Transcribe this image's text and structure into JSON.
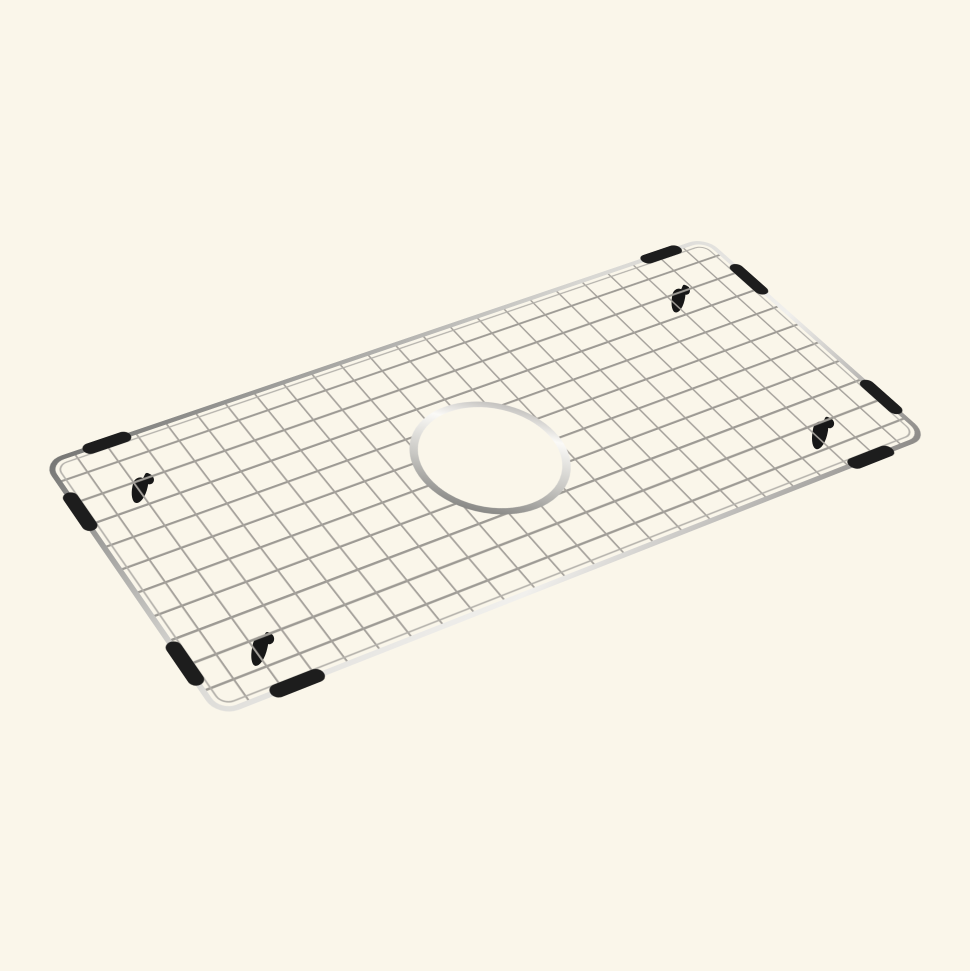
{
  "canvas": {
    "width": 970,
    "height": 971,
    "background": "#FAF6EA"
  },
  "subject": "stainless-steel-sink-bottom-grid",
  "grid": {
    "transform": "matrix3d(1.075, -0.27845, 0, 0.00018135, 0.50751, 0.59261, 0, -0.00036312, 0, 0, 1, 0, 42, 462, 0, 1)",
    "surface": {
      "width": 700,
      "height": 300,
      "corner_radius": 16,
      "edge_inset": 9,
      "inner_corner_radius": 10
    },
    "wires": {
      "columns": 24,
      "rows": 11,
      "cross_color": "#a6a29c",
      "cross_width": 1.7,
      "long_color": "#9d9a94",
      "long_width": 2.3,
      "inner_rect_color": "#b4b1ab",
      "inner_rect_width": 1.5,
      "end_margin": 4
    },
    "rim": {
      "stroke_width": 5,
      "gradient": [
        "#767674",
        "#d8d7d3",
        "#f1f0ed",
        "#8c8a87"
      ]
    },
    "hole": {
      "cx": 345,
      "cy": 157,
      "r": 64,
      "stroke_width": 7,
      "fill": "#FAF6EA",
      "gradient": [
        "#6b6b69",
        "#c8c7c3",
        "#fbfaf7",
        "#9a9895"
      ]
    },
    "bumpers": {
      "color": "#1d1d1d",
      "width": 13,
      "segments": [
        {
          "x1": 44,
          "y1": 3,
          "x2": 76,
          "y2": 3
        },
        {
          "x1": 630,
          "y1": 3,
          "x2": 662,
          "y2": 3
        },
        {
          "x1": 3,
          "y1": 48,
          "x2": 3,
          "y2": 82
        },
        {
          "x1": 3,
          "y1": 226,
          "x2": 3,
          "y2": 260
        },
        {
          "x1": 697,
          "y1": 50,
          "x2": 697,
          "y2": 84
        },
        {
          "x1": 697,
          "y1": 226,
          "x2": 697,
          "y2": 260
        },
        {
          "x1": 54,
          "y1": 297,
          "x2": 88,
          "y2": 297
        },
        {
          "x1": 620,
          "y1": 297,
          "x2": 654,
          "y2": 297
        }
      ]
    },
    "feet": {
      "color": "#171717",
      "items": [
        {
          "x": 673,
          "y": 286,
          "w": 16,
          "h": 27,
          "rot": 9
        },
        {
          "x": 814,
          "y": 418,
          "w": 19,
          "h": 32,
          "rot": 10
        },
        {
          "x": 134,
          "y": 474,
          "w": 19,
          "h": 30,
          "rot": 12
        },
        {
          "x": 254,
          "y": 633,
          "w": 19,
          "h": 34,
          "rot": 12
        }
      ]
    }
  }
}
